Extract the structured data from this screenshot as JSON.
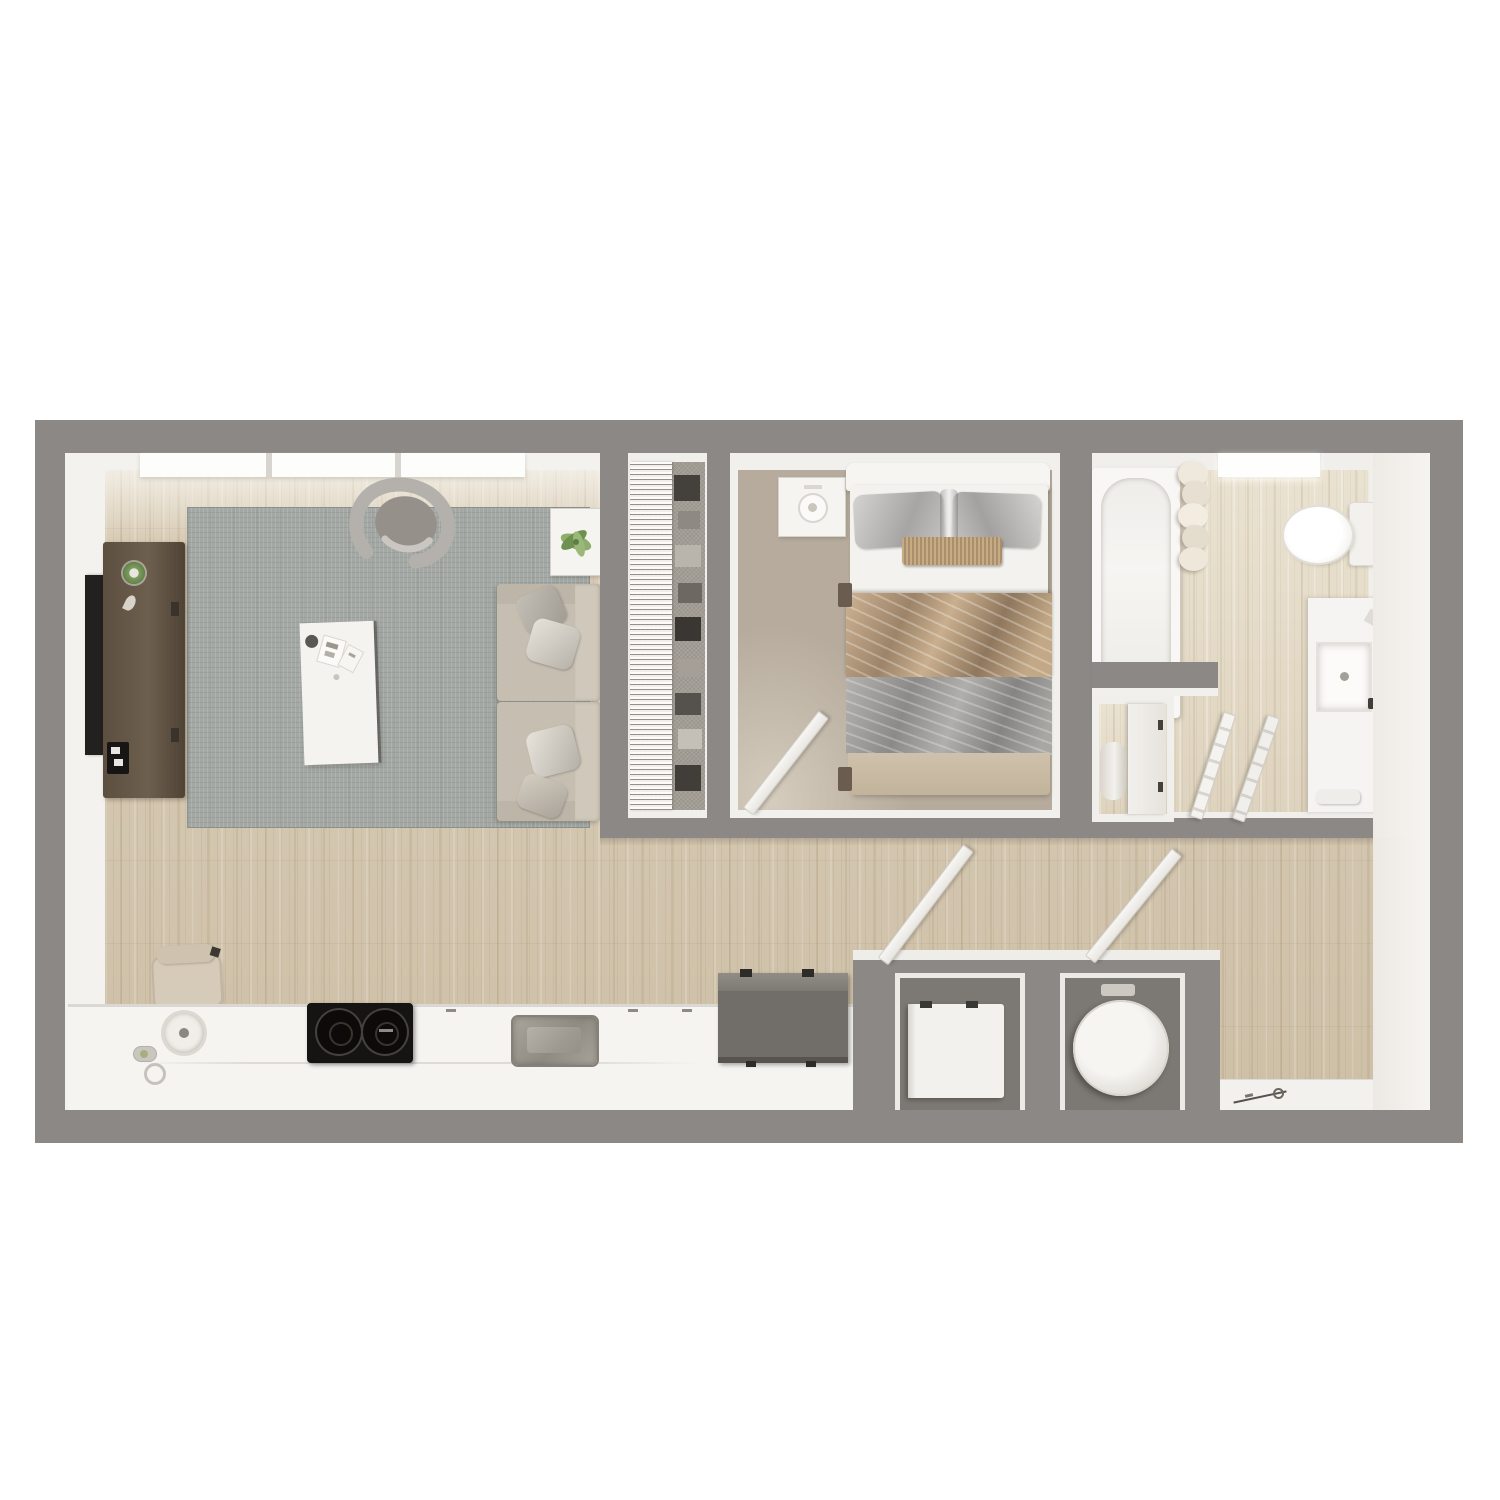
{
  "meta": {
    "title": "One-bedroom apartment floor plan — 3D top-down render",
    "render_style": "photorealistic bird's-eye 3D floor plan on white background",
    "text_labels_visible": "none"
  },
  "palette": {
    "page_background": "#ffffff",
    "wall_gray": "#8b8885",
    "wall_face_white": "#f2f0ec",
    "wood_floor": "#d5c7b0",
    "bathroom_wood": "#e6ddcb",
    "bedroom_carpet": "#b6ab9c",
    "closet_carpet": "#a19c94",
    "area_rug_gray": "#a3a8a4",
    "sofa_beige": "#c6beb1",
    "console_walnut": "#66594a",
    "appliance_black": "#161412",
    "fridge_gray": "#716d68",
    "fixture_white": "#f5f4f1"
  },
  "rooms": [
    {
      "id": "living-room",
      "label": "Living room",
      "furniture": [
        "wall-tv",
        "media-console",
        "decor-plant",
        "game-console",
        "area-rug",
        "curved-accent-chair",
        "coffee-table",
        "side-table-with-plant",
        "sofa-seat-upper",
        "sofa-seat-lower"
      ],
      "windows": 3
    },
    {
      "id": "closet",
      "label": "Reach-in closet",
      "furniture": [
        "wire-shelving",
        "hanging-clothes"
      ]
    },
    {
      "id": "bedroom",
      "label": "Bedroom",
      "furniture": [
        "nightstand",
        "headboard",
        "bed-pillows",
        "bolster-pillow",
        "bronze-throw-blanket",
        "gray-throw-blanket",
        "open-door"
      ]
    },
    {
      "id": "bathroom",
      "label": "Bathroom",
      "furniture": [
        "bathtub",
        "shower-curtain",
        "toilet",
        "vanity-counter",
        "vanity-sink",
        "faucet-knobs",
        "towels",
        "linen-closet",
        "rolled-towel",
        "double-door"
      ],
      "skylights": 1
    },
    {
      "id": "kitchen",
      "label": "Kitchen / hall",
      "furniture": [
        "counter-run",
        "round-sink",
        "soap-items",
        "two-burner-cooktop",
        "basin-sink",
        "refrigerator",
        "desk-chair"
      ]
    },
    {
      "id": "utility",
      "label": "Utility closets",
      "furniture": [
        "washer",
        "water-heater",
        "open-door-left",
        "open-door-right"
      ]
    },
    {
      "id": "entry",
      "label": "Entry",
      "furniture": [
        "threshold-mat",
        "keys"
      ]
    }
  ],
  "counts": {
    "windows": 3,
    "skylights": 1,
    "open_doors": 5,
    "rooms": 7
  }
}
